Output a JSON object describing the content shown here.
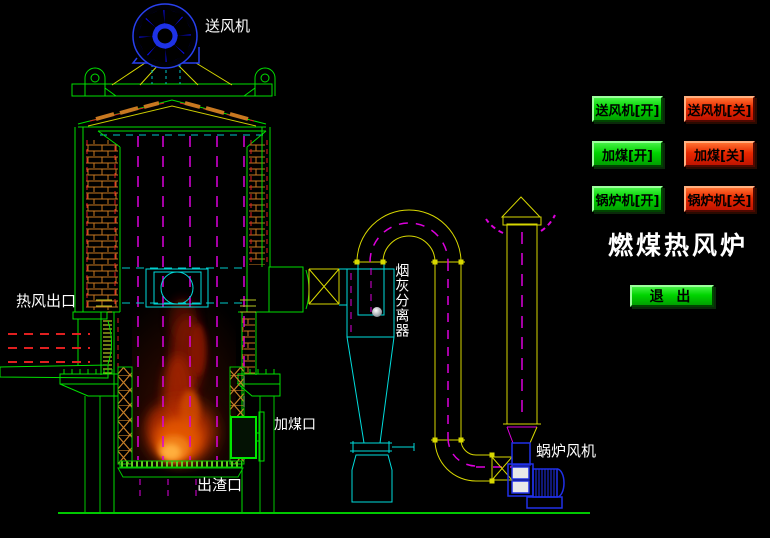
{
  "window": {
    "width": 770,
    "height": 538,
    "background": "#000000"
  },
  "title": "燃煤热风炉",
  "palette": {
    "line_green": "#00E000",
    "line_yellow": "#D8D800",
    "line_cyan": "#00DCDC",
    "line_magenta": "#DC00DC",
    "line_red": "#E02020",
    "line_orange": "#C87820",
    "fan_blue": "#1420E6",
    "button_green": "#00D400",
    "button_red": "#E82800",
    "label_text": "#FFFFFF",
    "flame_orange": "#F07D15"
  },
  "controls": {
    "buttons": [
      {
        "id": "blast-fan-on",
        "label": "送风机[开]",
        "color": "green"
      },
      {
        "id": "blast-fan-off",
        "label": "送风机[关]",
        "color": "red"
      },
      {
        "id": "coal-feed-on",
        "label": "加煤[开]",
        "color": "green"
      },
      {
        "id": "coal-feed-off",
        "label": "加煤[关]",
        "color": "red"
      },
      {
        "id": "boiler-on",
        "label": "锅炉机[开]",
        "color": "green"
      },
      {
        "id": "boiler-off",
        "label": "锅炉机[关]",
        "color": "red"
      }
    ],
    "exit_label": "退 出"
  },
  "diagram_labels": {
    "blast_fan": "送风机",
    "hot_air_outlet": "热风出口",
    "ash_separator": "烟灰分离器",
    "coal_feed_port": "加煤口",
    "slag_outlet": "出渣口",
    "boiler_fan": "蜗炉风机"
  }
}
